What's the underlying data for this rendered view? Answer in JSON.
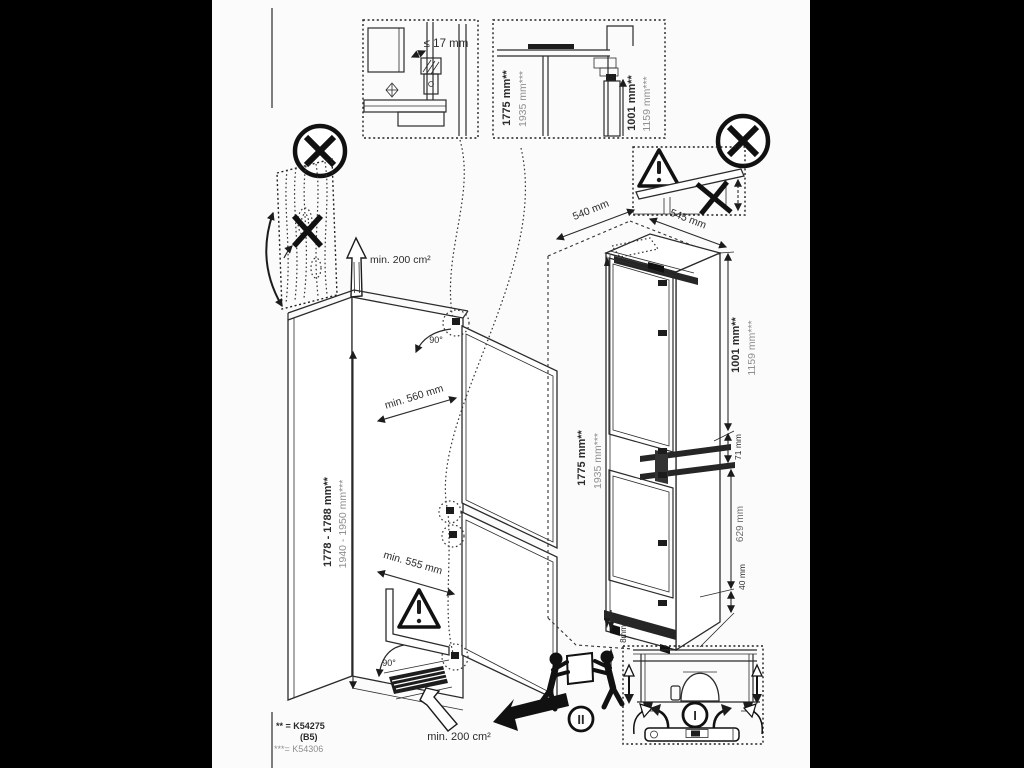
{
  "page": {
    "background": "#000000",
    "paper": "#fbfbfb",
    "ink": "#2b2b2b",
    "muted": "#8f8f8f"
  },
  "labels": {
    "hinge_gap": "≤ 17 mm",
    "detail_height_primary": "1775 mm**",
    "detail_height_secondary": "1935 mm***",
    "detail_upper_primary": "1001 mm**",
    "detail_upper_secondary": "1159 mm***",
    "top_width": "540 mm",
    "top_depth": "545 mm",
    "appliance_height_primary": "1775 mm**",
    "appliance_height_secondary": "1935 mm***",
    "upper_section_primary": "1001 mm**",
    "upper_section_secondary": "1159 mm***",
    "hinge_zone": "71 mm",
    "lower_section": "629 mm",
    "bottom_gap": "40 mm",
    "floor_gap": "8mm",
    "niche_height_primary": "1778 - 1788 mm**",
    "niche_height_secondary": "1940 - 1950 mm***",
    "niche_depth_top": "min. 560 mm",
    "niche_depth_bottom": "min. 555 mm",
    "door_angle_top": "90°",
    "door_angle_bottom": "90°",
    "vent_area_top": "min. 200 cm²",
    "vent_area_bottom": "min. 200 cm²",
    "step_carry": "II",
    "step_level": "I"
  },
  "footnote": {
    "line1": "** = K54275",
    "line2": "(B5)",
    "line3": "***= K54306"
  }
}
